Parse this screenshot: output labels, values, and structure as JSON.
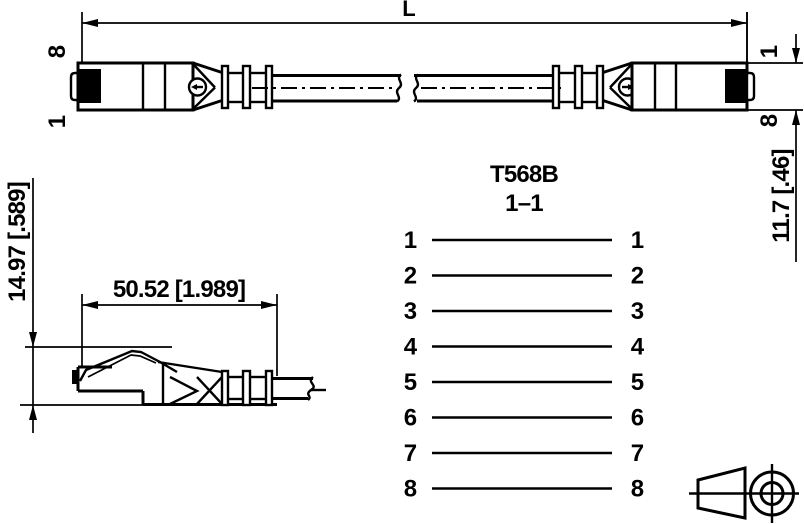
{
  "page": {
    "background": "#ffffff",
    "line_color": "#000000"
  },
  "top_view": {
    "length_label": "L",
    "left_connector": {
      "pin_top": "8",
      "pin_bottom": "1"
    },
    "right_connector": {
      "pin_top": "1",
      "pin_bottom": "8"
    },
    "height_dim": "11.7 [.46]"
  },
  "side_view": {
    "width_dim": "50.52 [1.989]",
    "height_dim": "14.97 [.589]"
  },
  "wiring": {
    "title": "T568B",
    "subtitle": "1–1",
    "pins": [
      {
        "left": "1",
        "right": "1"
      },
      {
        "left": "2",
        "right": "2"
      },
      {
        "left": "3",
        "right": "3"
      },
      {
        "left": "4",
        "right": "4"
      },
      {
        "left": "5",
        "right": "5"
      },
      {
        "left": "6",
        "right": "6"
      },
      {
        "left": "7",
        "right": "7"
      },
      {
        "left": "8",
        "right": "8"
      }
    ]
  },
  "icons": {
    "projection_symbol": "third-angle-projection-icon"
  }
}
